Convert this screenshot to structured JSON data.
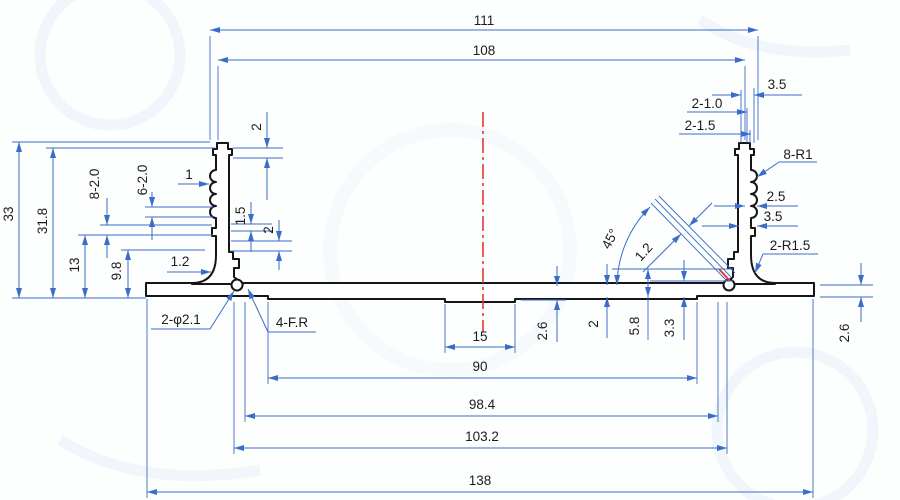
{
  "drawing_title": "aluminum extrusion profile cross-section drawing",
  "colors": {
    "dimension_blue": "#3a6cc8",
    "outline_black": "#161616",
    "centerline_red": "#e8372f",
    "paper": "#fdfefe"
  },
  "dims": {
    "width_111": "111",
    "width_108": "108",
    "top_right_3_5": "3.5",
    "top_right_2_1_0": "2-1.0",
    "top_right_2_1_5": "2-1.5",
    "radius_8_R1": "8-R1",
    "rib_2_5": "2.5",
    "rib_3_5": "3.5",
    "radius_2_R1_5": "2-R1.5",
    "height_33": "33",
    "height_31_8": "31.8",
    "height_13": "13",
    "height_9_8": "9.8",
    "ribs_8_2_0": "8-2.0",
    "ribs_6_2_0": "6-2.0",
    "depth_1": "1",
    "top_left_2": "2",
    "left_1_5": "1.5",
    "left_2": "2",
    "left_1_2": "1.2",
    "angle_45": "45°",
    "slot_1_2": "1.2",
    "holes_2_phi2_1": "2-φ2.1",
    "fillets_4_FR": "4-F.R",
    "width_15": "15",
    "thick_2_6": "2.6",
    "thick_2": "2",
    "height_5_8": "5.8",
    "height_3_3": "3.3",
    "right_2_6": "2.6",
    "width_90": "90",
    "width_98_4": "98.4",
    "width_103_2": "103.2",
    "width_138": "138"
  }
}
